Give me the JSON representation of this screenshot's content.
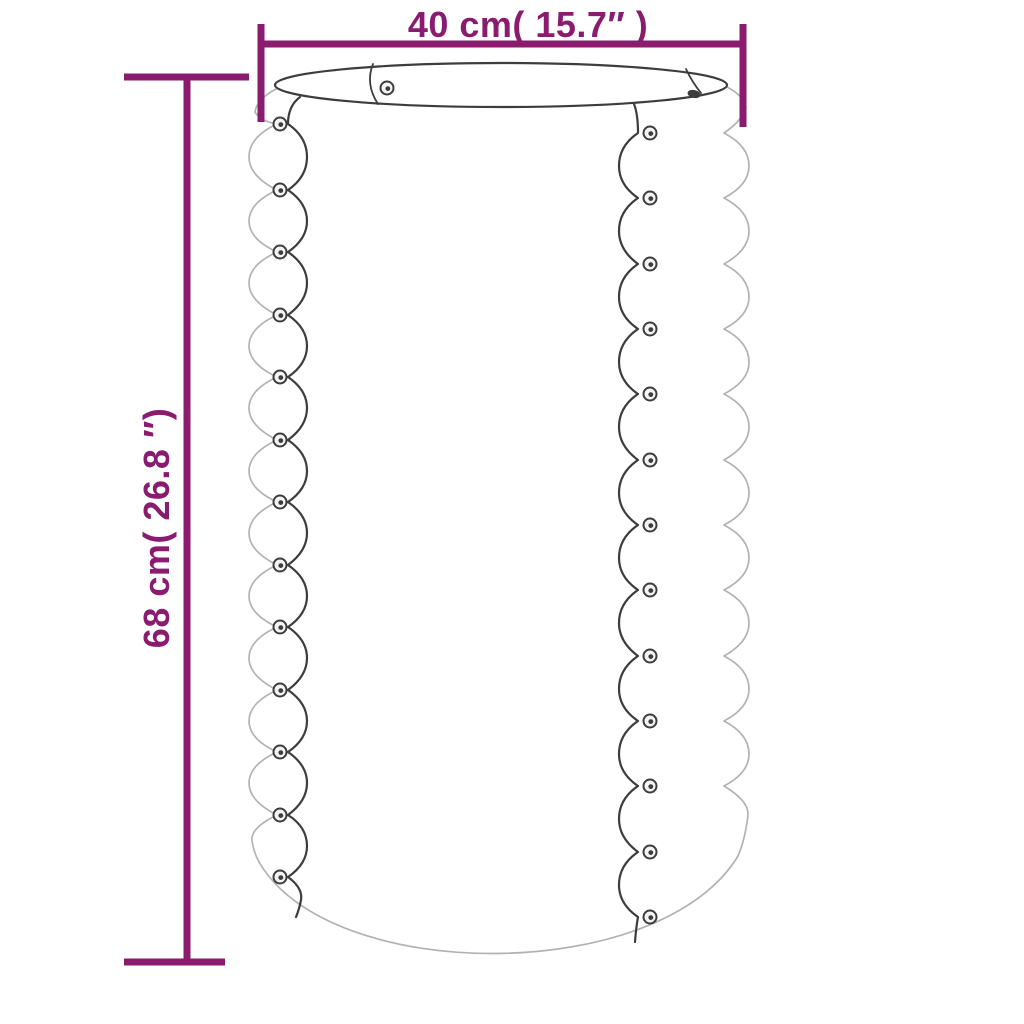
{
  "product_diagram": {
    "width_label": "40 cm( 15.7″ )",
    "height_label": "68 cm( 26.8 ″)"
  },
  "colors": {
    "dimension": "#8A1B6E",
    "outline_dark": "#3D3D3D",
    "outline_light": "#B2B2B2",
    "screw_fill": "#F4F4F4",
    "background": "#FFFFFF"
  }
}
